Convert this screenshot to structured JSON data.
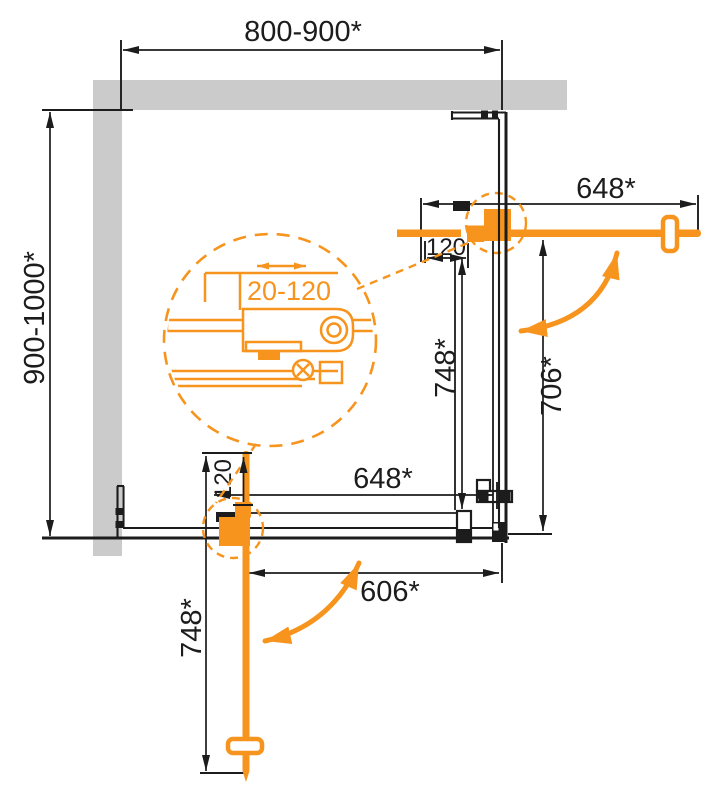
{
  "diagram": {
    "type": "shower-enclosure-installation-drawing",
    "view": "top-plan",
    "labels": {
      "top_width": "800-900*",
      "left_depth": "900-1000*",
      "top_door_width": "648*",
      "top_overlap": "120",
      "right_panel_width": "748*",
      "right_opening": "706*",
      "bottom_panel_width": "648*",
      "bottom_opening": "606*",
      "bottom_door_width": "748*",
      "bottom_overlap": "120",
      "adjustment_range": "20-120"
    },
    "colors": {
      "accent": "#F7941E",
      "wall": "#CBCBCB",
      "ink": "#1C1C1C"
    }
  }
}
